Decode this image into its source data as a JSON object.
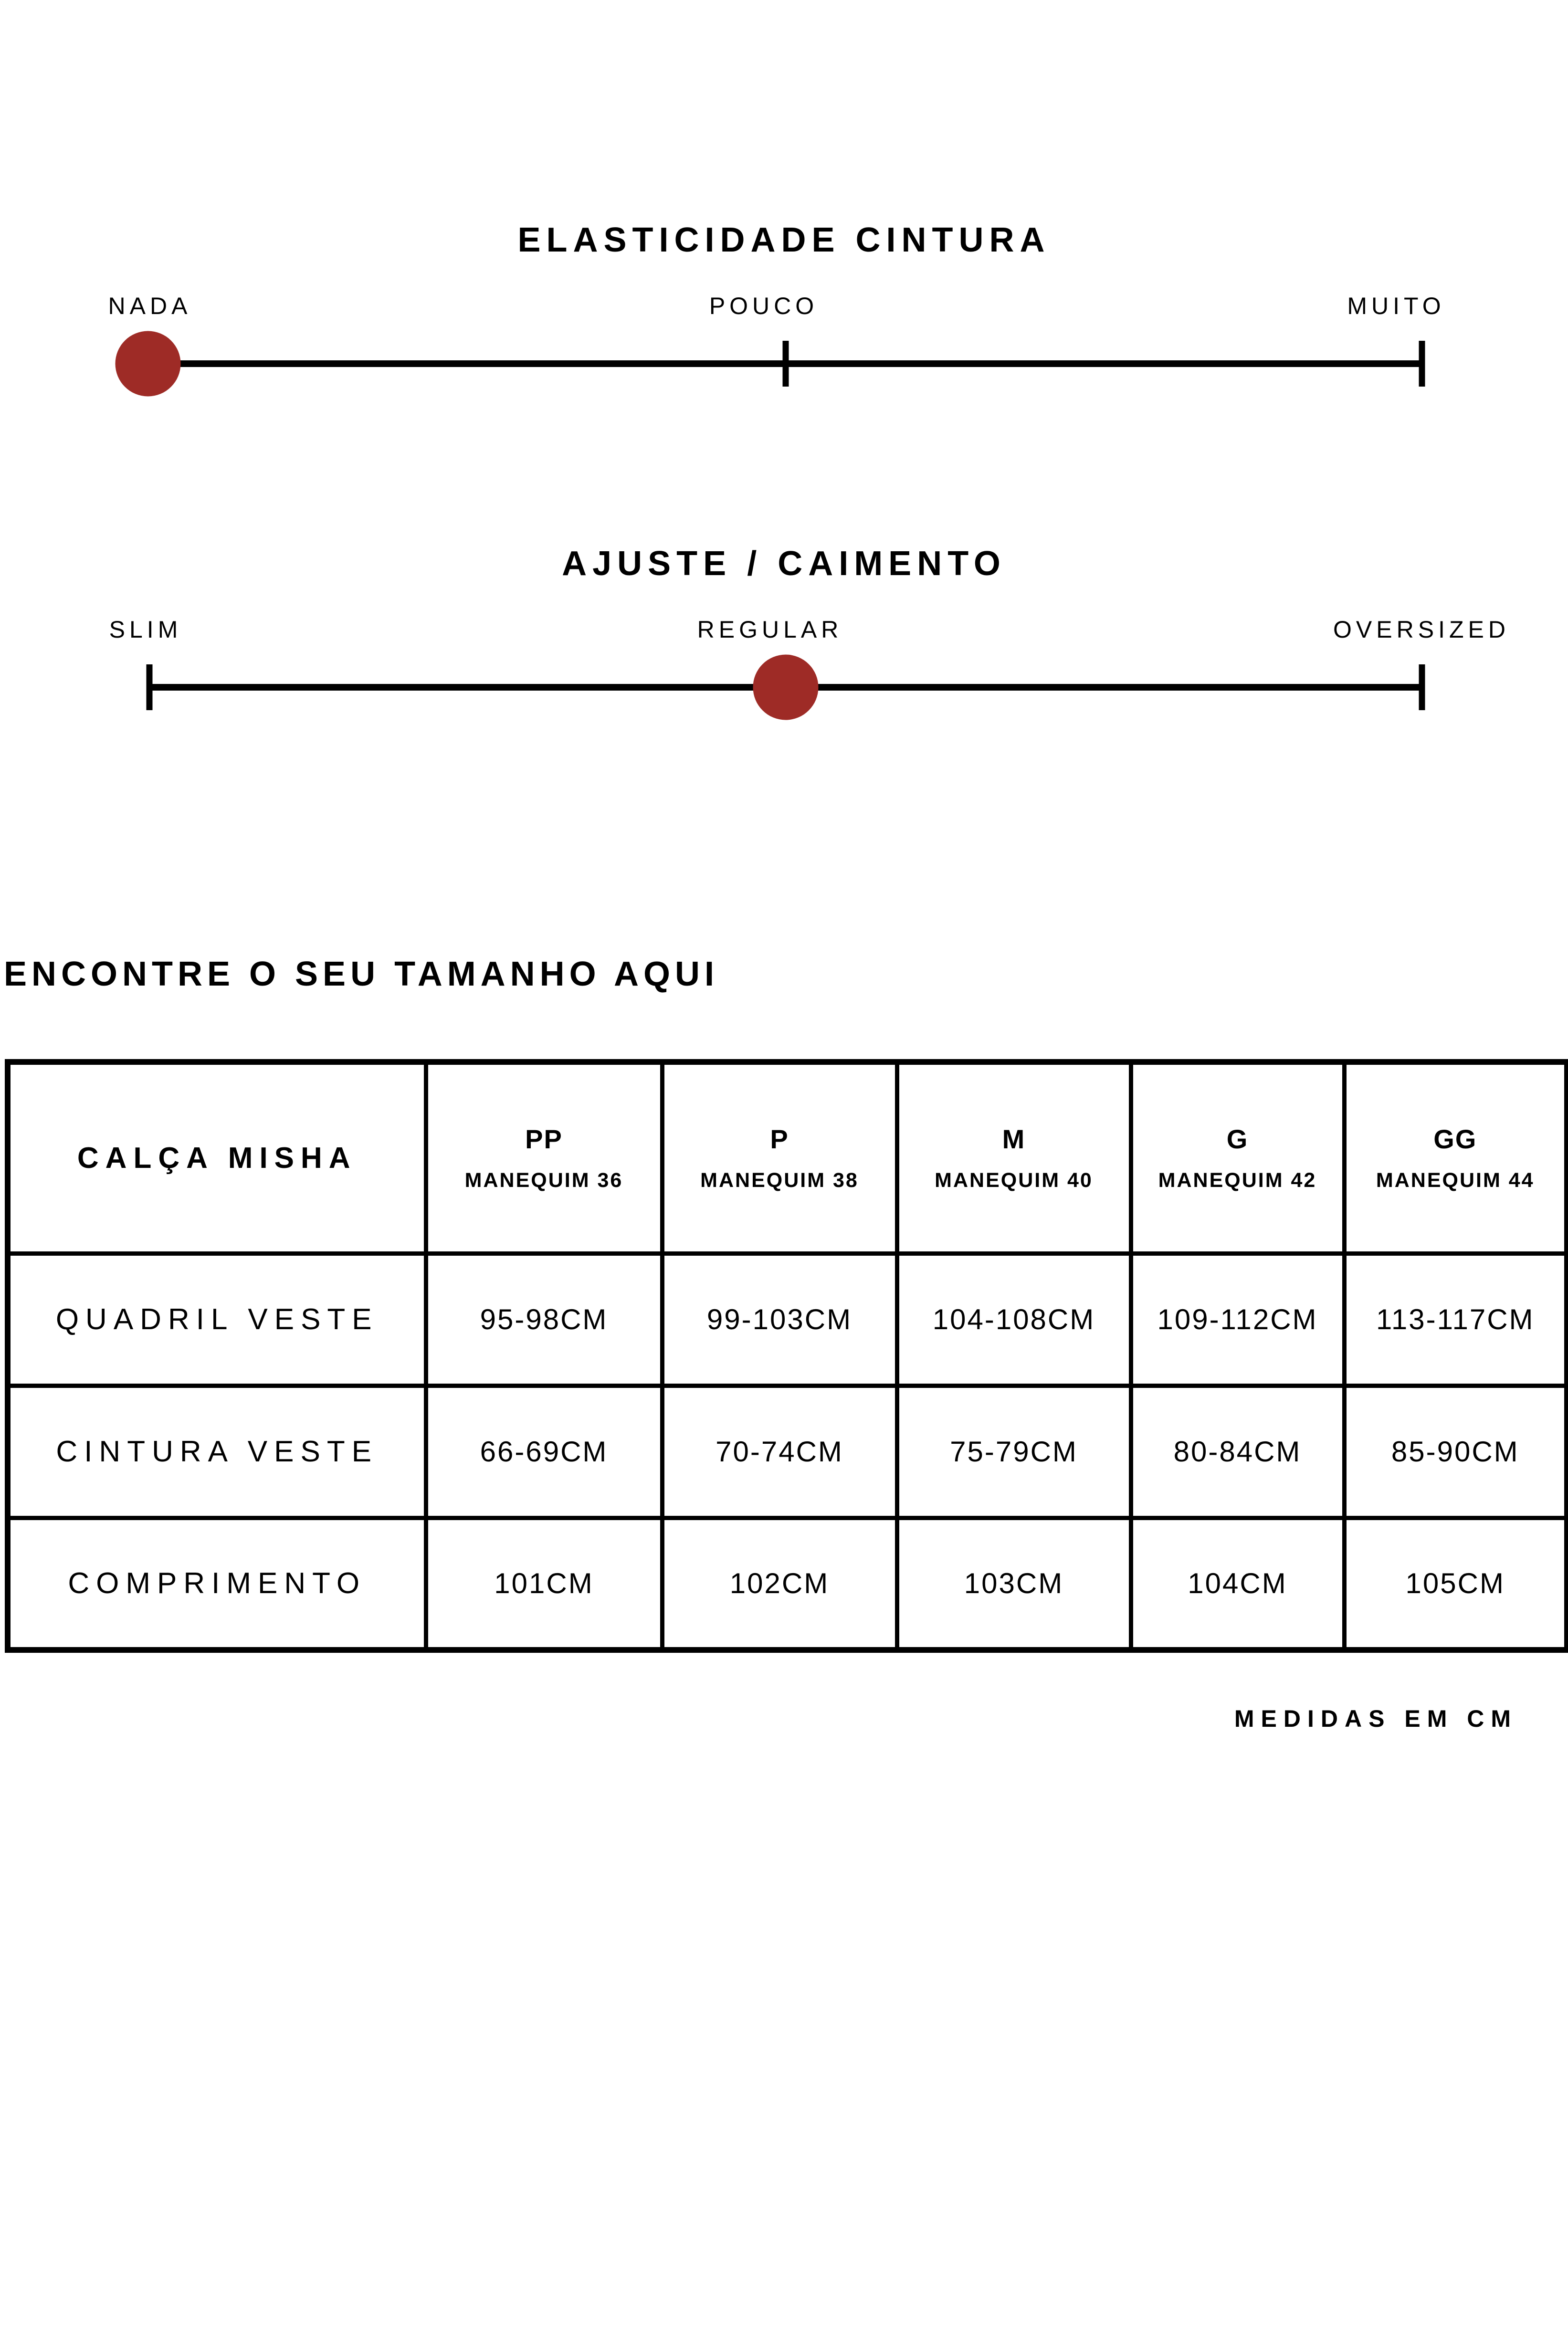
{
  "colors": {
    "background": "#FFFFFF",
    "ink": "#000000",
    "marker_red": "#9E2B26"
  },
  "sliders": [
    {
      "title": "ELASTICIDADE CINTURA",
      "min_label": "NADA",
      "mid_label": "POUCO",
      "max_label": "MUITO",
      "selected": "NADA"
    },
    {
      "title": "AJUSTE / CAIMENTO",
      "min_label": "SLIM",
      "mid_label": "REGULAR",
      "max_label": "OVERSIZED",
      "selected": "REGULAR"
    }
  ],
  "size_finder": {
    "heading": "ENCONTRE O SEU TAMANHO AQUI",
    "table": {
      "product_name": "CALÇA MISHA",
      "size_columns": [
        {
          "size": "PP",
          "mannequin": "MANEQUIM 36"
        },
        {
          "size": "P",
          "mannequin": "MANEQUIM 38"
        },
        {
          "size": "M",
          "mannequin": "MANEQUIM 40"
        },
        {
          "size": "G",
          "mannequin": "MANEQUIM 42"
        },
        {
          "size": "GG",
          "mannequin": "MANEQUIM 44"
        }
      ],
      "rows": [
        {
          "label": "QUADRIL VESTE",
          "values": [
            "95-98CM",
            "99-103CM",
            "104-108CM",
            "109-112CM",
            "113-117CM"
          ]
        },
        {
          "label": "CINTURA VESTE",
          "values": [
            "66-69CM",
            "70-74CM",
            "75-79CM",
            "80-84CM",
            "85-90CM"
          ]
        },
        {
          "label": "COMPRIMENTO",
          "values": [
            "101CM",
            "102CM",
            "103CM",
            "104CM",
            "105CM"
          ]
        }
      ],
      "footnote": "MEDIDAS EM CM"
    }
  }
}
